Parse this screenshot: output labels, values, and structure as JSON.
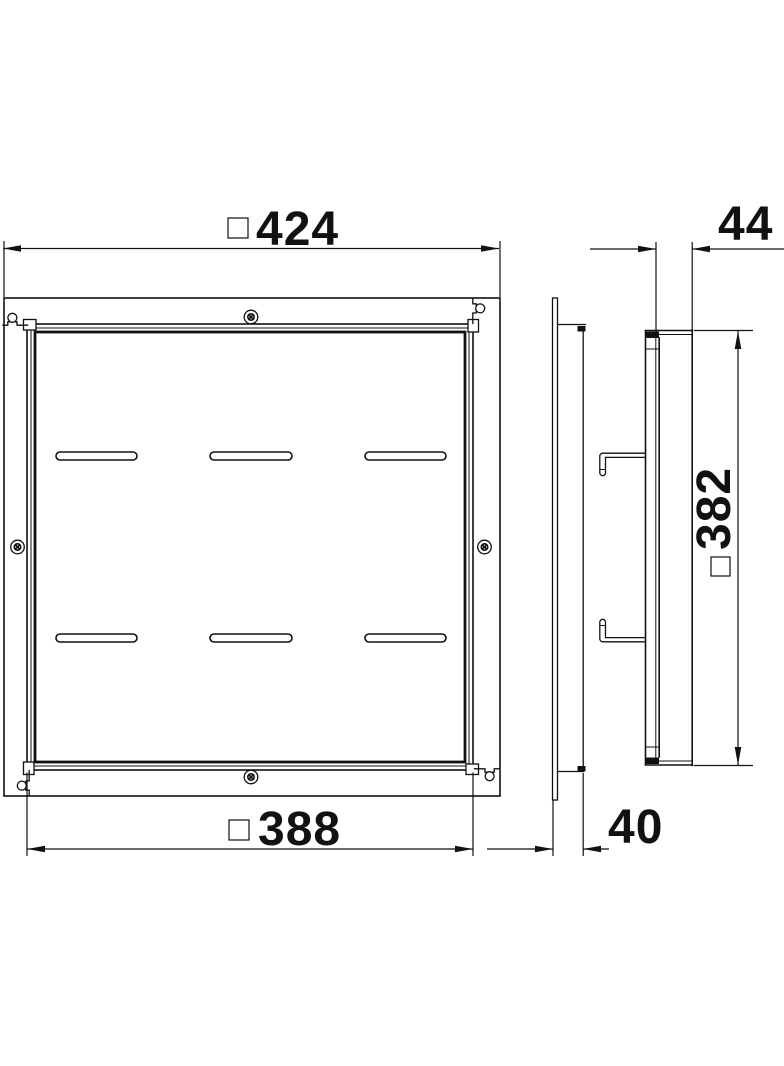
{
  "drawing": {
    "views": {
      "front_view": {
        "slot_rows": 2,
        "slots_per_row": 3,
        "screws": 4,
        "corner_cutouts": 4
      },
      "side_view": {
        "mounting_hooks": 2
      }
    },
    "dimensions": {
      "front_width": {
        "symbol": "□",
        "value": "424"
      },
      "front_inner_width": {
        "symbol": "□",
        "value": "388"
      },
      "side_depth_top": {
        "symbol": "",
        "value": "44"
      },
      "side_inner_height": {
        "symbol": "□",
        "value": "382"
      },
      "side_depth_bottom": {
        "symbol": "",
        "value": "40"
      }
    },
    "colors": {
      "line": "#111111",
      "background": "#ffffff"
    }
  }
}
